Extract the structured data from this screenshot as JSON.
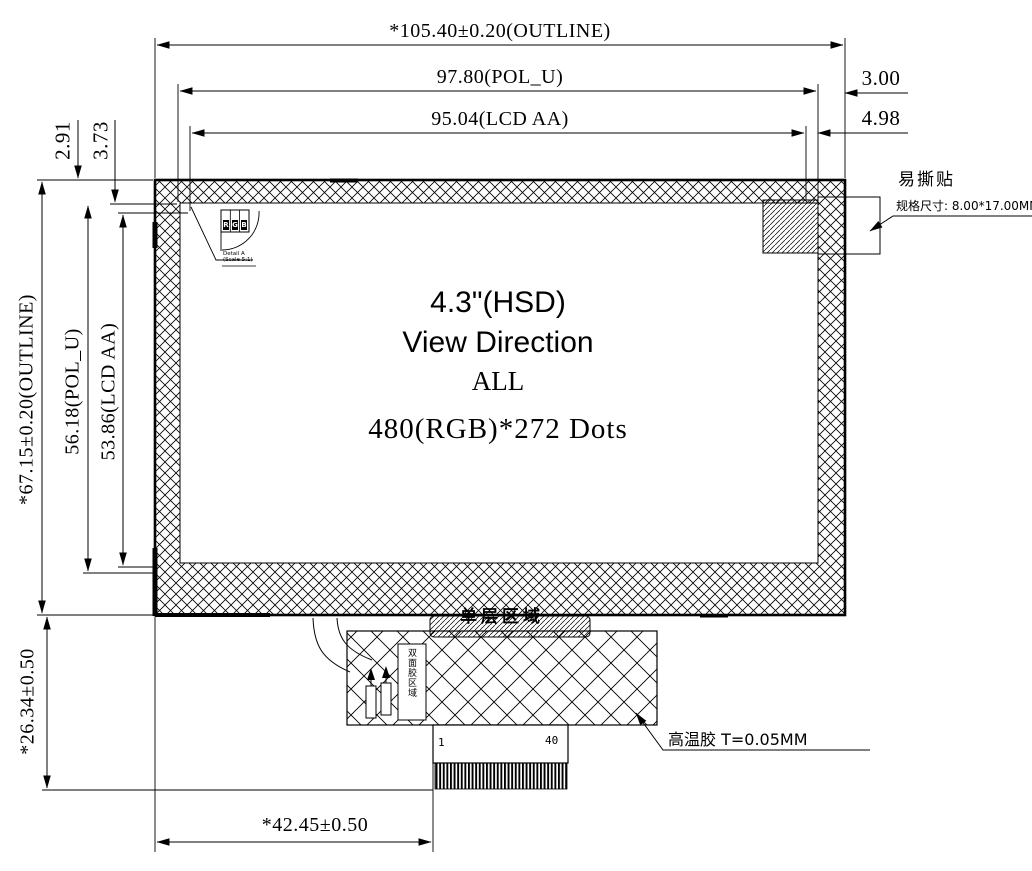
{
  "drawing": {
    "panel_text": {
      "size": "4.3\"(HSD)",
      "view": "View Direction",
      "direction": "ALL",
      "resolution": "480(RGB)*272 Dots"
    },
    "dimensions": {
      "outline_width": "*105.40±0.20(OUTLINE)",
      "pol_width": "97.80(POL_U)",
      "aa_width": "95.04(LCD AA)",
      "right_offset_pol": "3.00",
      "right_offset_aa": "4.98",
      "top_offset_pol": "2.91",
      "top_offset_aa": "3.73",
      "outline_height": "*67.15±0.20(OUTLINE)",
      "pol_height": "56.18(POL_U)",
      "aa_height": "53.86(LCD AA)",
      "fpc_height": "*26.34±0.50",
      "connector_offset": "*42.45±0.50"
    },
    "annotations": {
      "sticker_label": "易撕贴",
      "sticker_spec": "规格尺寸: 8.00*17.00MM",
      "tape_label": "高温胶 T=0.05MM",
      "single_layer_label": "单层区域",
      "fpc_box_label": "双面胶区域",
      "detail_line1": "Detail A",
      "detail_line2": "(Scale 5:1)",
      "pixel_letters": [
        "R",
        "G",
        "B"
      ]
    },
    "connector": {
      "pin_first": "1",
      "pin_last": "40"
    },
    "colors": {
      "line": "#000000",
      "background": "#ffffff"
    }
  }
}
